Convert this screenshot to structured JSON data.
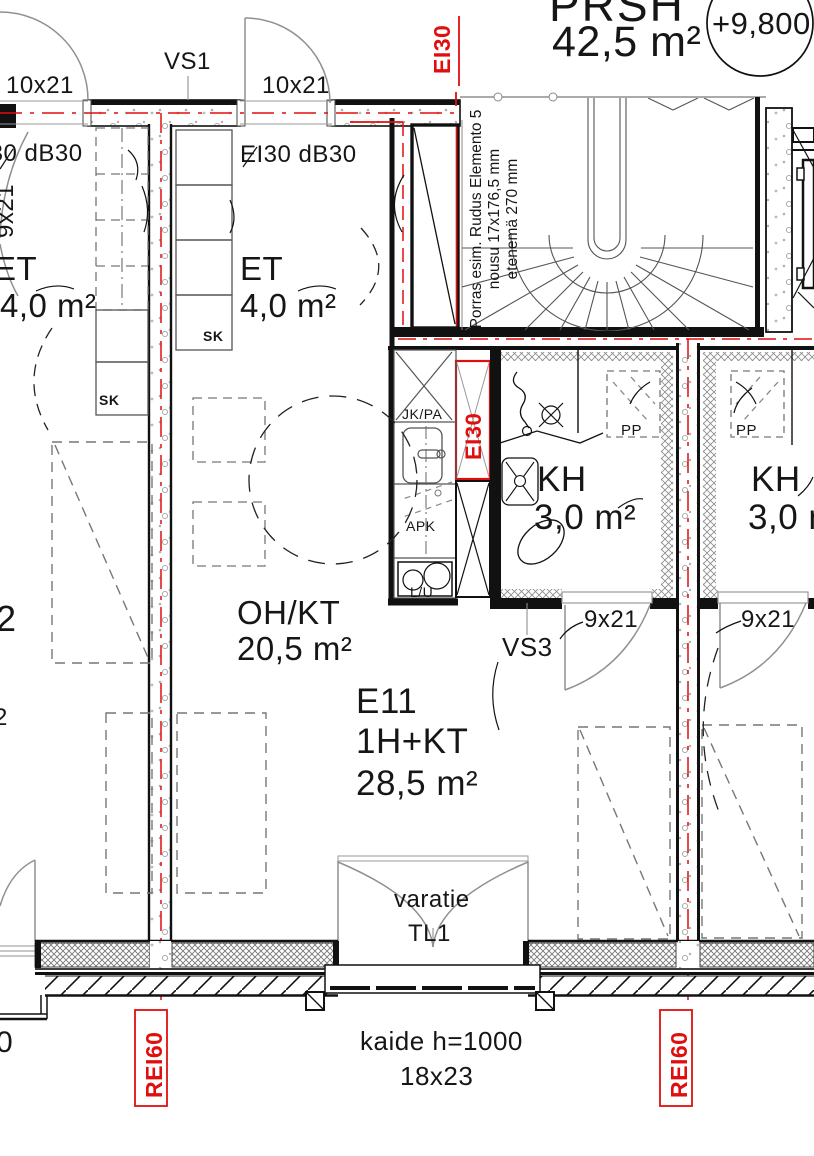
{
  "colors": {
    "red": "#e10e0e",
    "line": "#111111",
    "gray": "#8c8c8c"
  },
  "apartment": {
    "id": "E11",
    "type": "1H+KT",
    "area": "28,5 m²"
  },
  "rooms": {
    "prsh": {
      "name": "PRSH",
      "area": "42,5 m²"
    },
    "et_left": {
      "name": "ET",
      "area": "4,0 m²"
    },
    "et_right": {
      "name": "ET",
      "area": "4,0 m²"
    },
    "ohkt": {
      "name": "OH/KT",
      "area": "20,5 m²"
    },
    "kh_e11": {
      "name": "KH",
      "area": "3,0 m²"
    },
    "kh_right": {
      "name": "KH",
      "area": "3,0 m²"
    }
  },
  "doors": {
    "size_top_left": "10x21",
    "size_top_right": "10x21",
    "size_left_rotated": "9x21",
    "size_kh_e11": "9x21",
    "size_kh_right": "9x21",
    "size_balcony": "18x23"
  },
  "walls": {
    "vs1": "VS1",
    "vs3": "VS3"
  },
  "fire": {
    "ei30_top": "EI30",
    "ei30_shaft": "EI30",
    "ei30db30_left": "EI30 dB30",
    "ei30db30_right": "EI30 dB30",
    "rei60_left": "REI60",
    "rei60_right": "REI60"
  },
  "fixtures": {
    "jkpa": "JK/PA",
    "apk": "APK",
    "lu": "L/U",
    "pp_left": "PP",
    "pp_right": "PP",
    "sk_left": "SK",
    "sk_right": "SK"
  },
  "stair": {
    "note1": "Porras esim. Rudus Elemento 5",
    "note2": "nousu 17x176,5 mm",
    "note3": "etenemä 270 mm"
  },
  "annotations": {
    "level": "+9,800",
    "varatie": "varatie",
    "tl1": "TL1",
    "kaide": "kaide h=1000",
    "fragment_2a": "2",
    "fragment_2b": "2",
    "fragment_0": "0"
  }
}
